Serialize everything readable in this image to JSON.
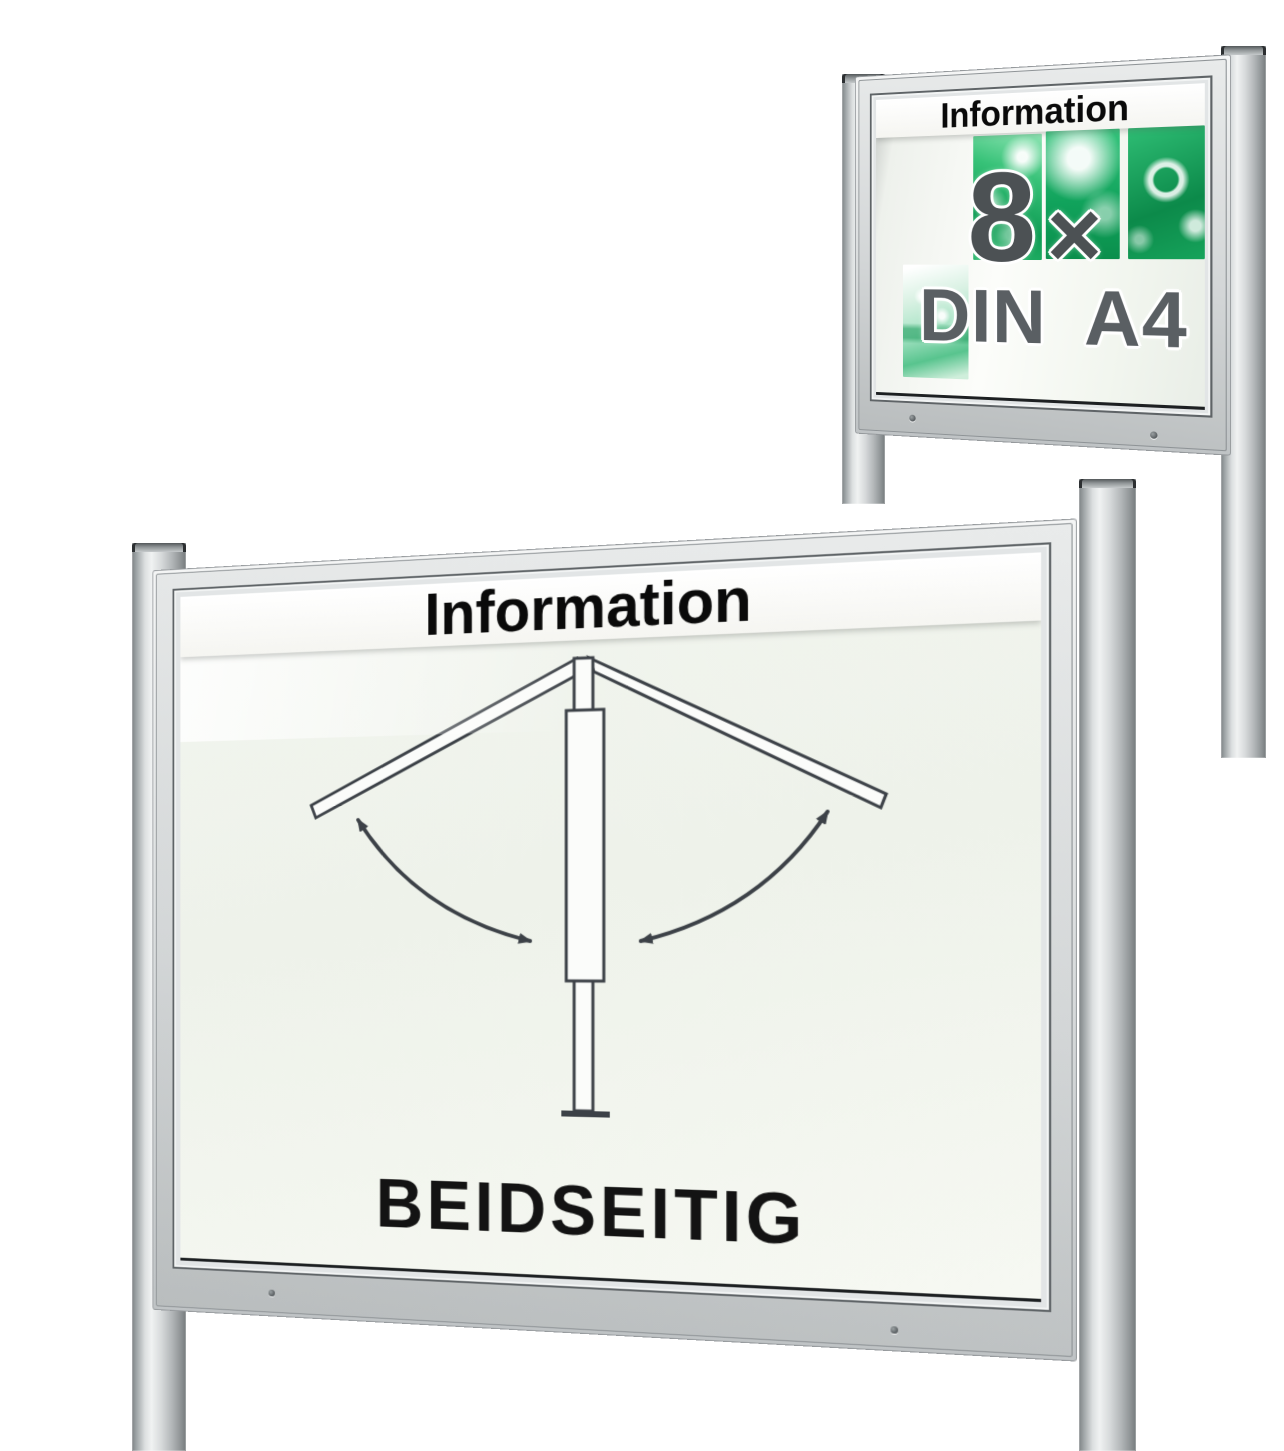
{
  "scene": {
    "type": "product-render-montage",
    "background_color": "#ffffff"
  },
  "small_display_case": {
    "header_label": "Information",
    "capacity_count": "8",
    "capacity_times_symbol": "×",
    "capacity_format": "DIN A4",
    "poster_tile_count": 4,
    "screw_count": 2,
    "colors": {
      "header_text": "#0a0a0a",
      "capacity_text": "#4c5154",
      "format_text": "#5a5f63",
      "tile_green_bright": "#21b56b",
      "tile_green_dark": "#0e9050",
      "tile_green_pale": "#bce9d2"
    }
  },
  "large_display_case": {
    "header_label": "Information",
    "caption": "BEIDSEITIG",
    "screw_count": 2,
    "diagram_name": "double-sided-swing-open-doors",
    "colors": {
      "header_text": "#0a0a0a",
      "caption_text": "#131313",
      "diagram_stroke": "#3c4147",
      "glass_tint": "#f2f5ef"
    }
  },
  "hardware_colors": {
    "frame_silver": "#ced2d3",
    "post_silver": "#c0c4c6",
    "seam_dark": "#5f6467"
  }
}
